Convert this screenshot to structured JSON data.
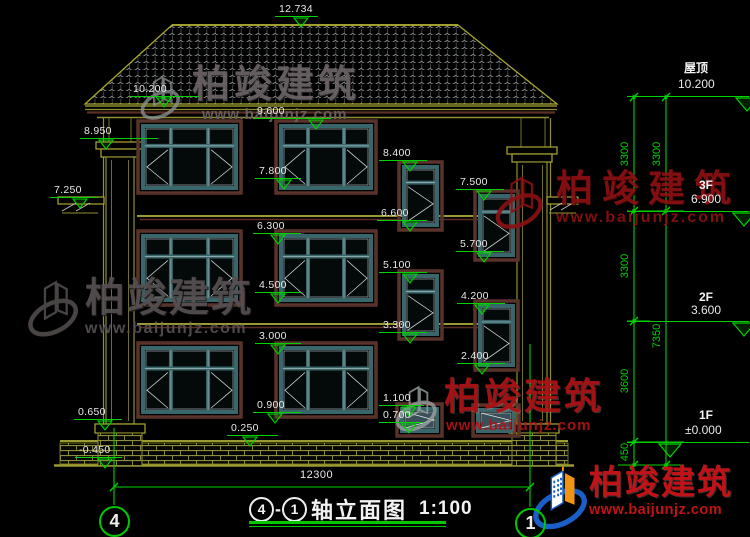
{
  "watermark": {
    "brand": "柏竣建筑",
    "url": "www.baijunjz.com"
  },
  "drawing": {
    "levels": {
      "ridge": "12.734",
      "roof_eave": "10.200",
      "win3f_top": "9.600",
      "capital": "8.950",
      "ledge_left": "7.250",
      "win3f_bottom": "7.800",
      "stair_a_top": "8.400",
      "stair_a_bottom": "6.600",
      "stair_b_top": "7.500",
      "stair_b_bottom": "5.700",
      "win2f_top": "6.300",
      "win2f_bottom": "4.500",
      "stair_c_top": "5.100",
      "stair_c_bottom": "3.300",
      "stair_d_top": "4.200",
      "stair_d_bottom": "2.400",
      "win1f_top": "3.000",
      "win1f_bottom": "0.900",
      "base_ledge": "0.650",
      "plinth_top": "0.250",
      "small_win_top": "1.100",
      "small_win_bottom": "0.700",
      "ground": "-0.450"
    },
    "floor_levels": [
      {
        "floor": "屋顶",
        "value": "10.200"
      },
      {
        "floor": "3F",
        "value": "6.900"
      },
      {
        "floor": "2F",
        "value": "3.600"
      },
      {
        "floor": "1F",
        "value": "±0.000"
      }
    ],
    "vertical_dims_inner": [
      "3300",
      "3300",
      "3600",
      "450"
    ],
    "vertical_dims_outer": [
      "3300",
      "7350"
    ],
    "overall_width": "12300",
    "axes": {
      "left": "4",
      "right": "1"
    },
    "title": {
      "axis_start": "4",
      "dash": "-",
      "axis_end": "1",
      "name": "轴立面图",
      "scale": "1:100"
    }
  }
}
